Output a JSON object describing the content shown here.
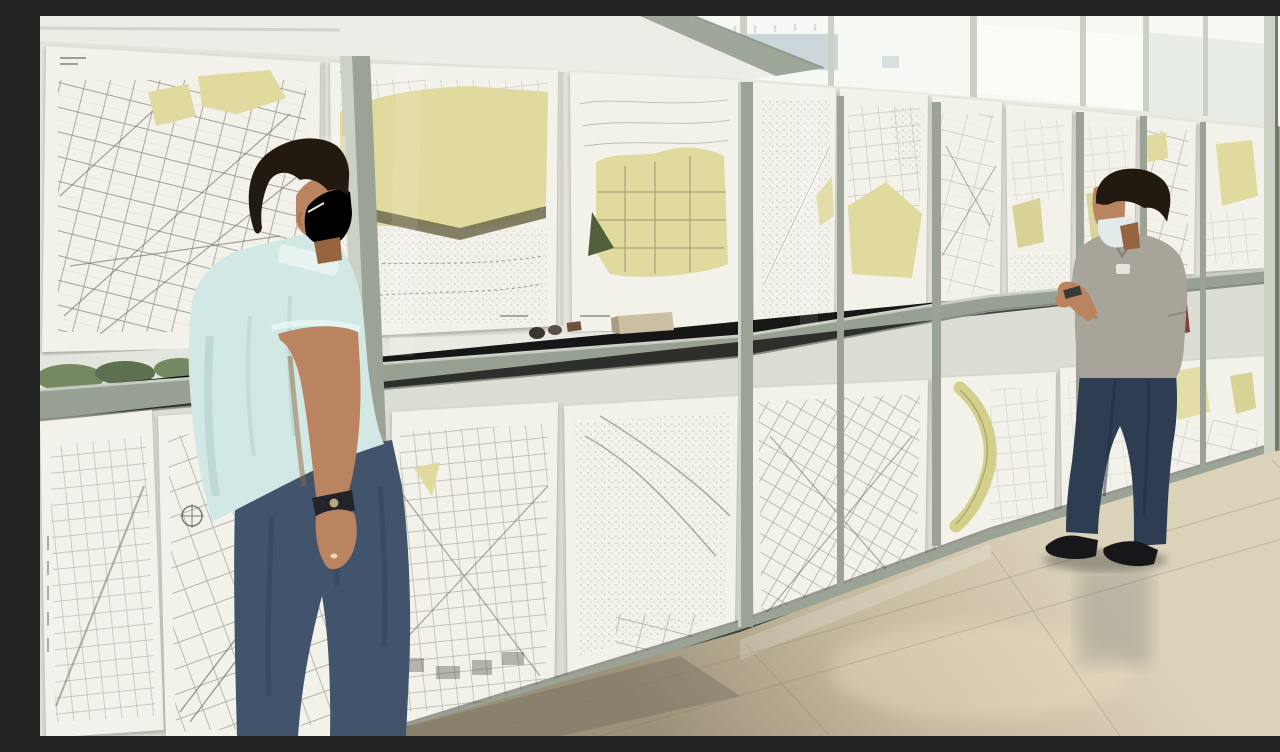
{
  "meta": {
    "title": "Citizens review municipal zoning plans",
    "description": "Two men wearing face masks study black-and-white city zoning maps with yellow planning zones, taped in two rows on a sage-framed glass partition wall inside a municipal building; a polished beige marble floor with reflections fills the foreground and a tan stone column closes the right side."
  },
  "people": [
    {
      "id": "man-left",
      "description": "Foreground man seen from behind in a pale blue short-sleeve shirt and dark jeans, surgical mask on his face, wristwatch and ring on his left hand, leaning toward the maps",
      "shirt": "pale blue",
      "mask_state": "worn over nose and mouth",
      "accessories": [
        "wristwatch",
        "ring"
      ]
    },
    {
      "id": "man-right",
      "description": "Man at the far end of the wall in a gray polo shirt and blue jeans, white mask pulled down under his chin, holding a small object in front and a dark red folder behind his back",
      "shirt": "gray polo with small white badge",
      "mask_state": "pulled below chin",
      "accessories": [
        "small held object",
        "red folder"
      ]
    }
  ],
  "display_wall": {
    "structure": "glass partition with sage-gray aluminium mullions and a mid-height rail",
    "rows": [
      {
        "id": "top-row",
        "map_count": 9
      },
      {
        "id": "bottom-row",
        "map_count": 8
      }
    ],
    "map_style": "cadastral street grids in black ink with yellow zoning areas, olive shore band, dark green park triangle and stippled terrain",
    "clerestory": "bright glazed band above the maps with a pale distant building visible outside",
    "exterior_view": "green shrubs visible through the glass at the lower left",
    "sill_items": "tan box and small dark objects resting on the mid rail"
  },
  "room": {
    "ceiling": "white with a sage diagonal beam",
    "floor": "polished beige marble tiles with glossy reflections",
    "right_wall": "tan mottled stone column"
  },
  "colors": {
    "ceiling": "#edece7",
    "pane": "#f6f8f4",
    "paneHaze": "#e7eae4",
    "buildingDistant": "#c7d2d6",
    "mullion": "#9aa396",
    "mullionLight": "#ccd1c6",
    "mullionDark": "#737b70",
    "paper": "#f2f1ea",
    "paperShade": "#d9d8d0",
    "mapLine": "#5f5f58",
    "mapYellow": "#e0da9e",
    "mapYellowDeep": "#d2cb82",
    "mapOlive": "#6e6a4c",
    "mapGreenDark": "#515f3b",
    "stippleGray": "#8f8f88",
    "greenery": "#768862",
    "greeneryDark": "#5d7050",
    "railFace": "#98a094",
    "sill": "#e9ebe3",
    "floorLight": "#dbd2ba",
    "floorMid": "#c2b89d",
    "floorDark": "#9b927a",
    "floorShadow": "#6f6753",
    "wallTan": "#b0a089",
    "wallTanDark": "#8d7c64",
    "skin": "#b9845f",
    "skinShadow": "#96653f",
    "hair": "#221910",
    "maskWhite": "#e2eaea",
    "shirtLeft": "#d2e8e4",
    "shirtLeftShade": "#aecfca",
    "jeansLeft": "#41546b",
    "jeansLeftDark": "#32445a",
    "shirtRight": "#a8a49a",
    "shirtRightShade": "#8b877d",
    "jeansRight": "#2e3d52",
    "shoe": "#17171a",
    "redFolder": "#7a2f22"
  }
}
